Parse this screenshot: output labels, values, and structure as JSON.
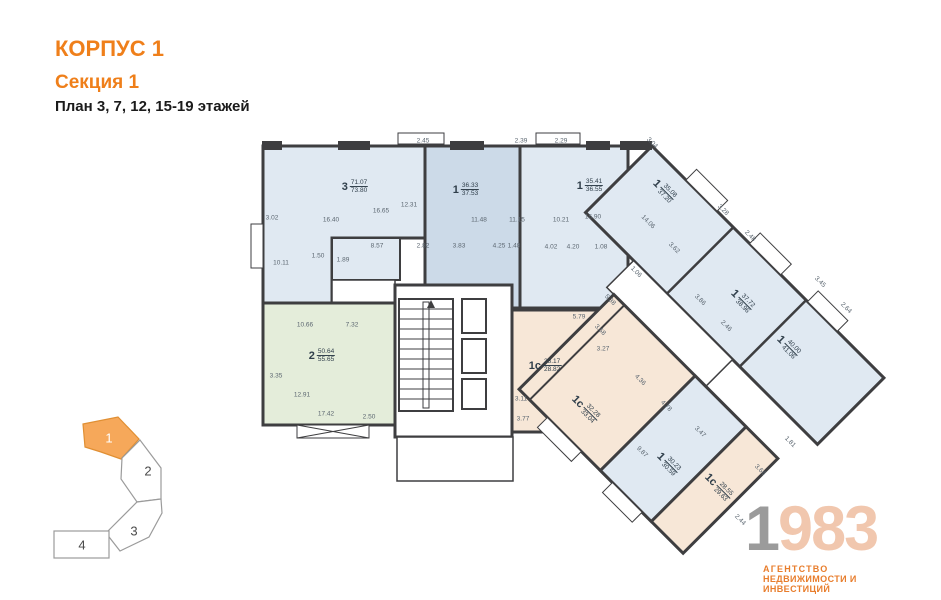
{
  "header": {
    "building": "КОРПУС 1",
    "section": "Секция 1",
    "plan_floors": "План 3, 7, 12, 15-19 этажей"
  },
  "colors": {
    "accent_orange": "#ef7f1a",
    "wall": "#3e3e40",
    "apartment_blue": "#e0e9f2",
    "apartment_blue_dark": "#ccdae8",
    "apartment_green": "#e4edda",
    "apartment_beige": "#f7e7d7",
    "key_plan_orange": "#f6a85a",
    "logo_gray": "#9b9b9b",
    "logo_peach": "#f1c7ae",
    "dimension_text": "#5b6670"
  },
  "plan": {
    "apartments": [
      {
        "type": "3",
        "area_top": "71.07",
        "area_bottom": "73.80",
        "x": 355,
        "y": 187,
        "r": 0
      },
      {
        "type": "1",
        "area_top": "36.33",
        "area_bottom": "37.53",
        "x": 466,
        "y": 190,
        "r": 0
      },
      {
        "type": "1",
        "area_top": "35.41",
        "area_bottom": "36.55",
        "x": 590,
        "y": 186,
        "r": 0
      },
      {
        "type": "1",
        "area_top": "35.08",
        "area_bottom": "37.20",
        "x": 664,
        "y": 191,
        "r": 45
      },
      {
        "type": "1",
        "area_top": "37.72",
        "area_bottom": "38.96",
        "x": 742,
        "y": 301,
        "r": 45
      },
      {
        "type": "1",
        "area_top": "40.00",
        "area_bottom": "41.06",
        "x": 788,
        "y": 347,
        "r": 45
      },
      {
        "type": "2",
        "area_top": "50.64",
        "area_bottom": "55.65",
        "x": 322,
        "y": 356,
        "r": 0
      },
      {
        "type": "1с",
        "area_top": "28.17",
        "area_bottom": "28.82",
        "x": 545,
        "y": 366,
        "r": 0
      },
      {
        "type": "1с",
        "area_top": "32.28",
        "area_bottom": "33.04",
        "x": 585,
        "y": 409,
        "r": 45
      },
      {
        "type": "1",
        "area_top": "30.23",
        "area_bottom": "30.59",
        "x": 668,
        "y": 464,
        "r": 45
      },
      {
        "type": "1с",
        "area_top": "28.55",
        "area_bottom": "29.63",
        "x": 718,
        "y": 487,
        "r": 45
      }
    ],
    "dimensions": [
      {
        "v": "2.45",
        "x": 423,
        "y": 141,
        "r": 0
      },
      {
        "v": "2.39",
        "x": 521,
        "y": 141,
        "r": 0
      },
      {
        "v": "2.29",
        "x": 561,
        "y": 141,
        "r": 0
      },
      {
        "v": "3.04",
        "x": 652,
        "y": 143,
        "r": 45
      },
      {
        "v": "3.02",
        "x": 272,
        "y": 218,
        "r": 0
      },
      {
        "v": "16.40",
        "x": 331,
        "y": 220,
        "r": 0
      },
      {
        "v": "16.65",
        "x": 381,
        "y": 211,
        "r": 0
      },
      {
        "v": "12.31",
        "x": 409,
        "y": 205,
        "r": 0
      },
      {
        "v": "11.48",
        "x": 479,
        "y": 220,
        "r": 0
      },
      {
        "v": "11.15",
        "x": 517,
        "y": 220,
        "r": 0
      },
      {
        "v": "10.21",
        "x": 561,
        "y": 220,
        "r": 0
      },
      {
        "v": "15.90",
        "x": 593,
        "y": 217,
        "r": 0
      },
      {
        "v": "8.57",
        "x": 377,
        "y": 246,
        "r": 0
      },
      {
        "v": "2.82",
        "x": 423,
        "y": 246,
        "r": 0
      },
      {
        "v": "3.83",
        "x": 459,
        "y": 246,
        "r": 0
      },
      {
        "v": "4.25",
        "x": 499,
        "y": 246,
        "r": 0
      },
      {
        "v": "1.48",
        "x": 514,
        "y": 246,
        "r": 0
      },
      {
        "v": "4.02",
        "x": 551,
        "y": 247,
        "r": 0
      },
      {
        "v": "4.20",
        "x": 573,
        "y": 247,
        "r": 0
      },
      {
        "v": "1.08",
        "x": 601,
        "y": 247,
        "r": 0
      },
      {
        "v": "1.50",
        "x": 318,
        "y": 256,
        "r": 0
      },
      {
        "v": "1.89",
        "x": 343,
        "y": 260,
        "r": 0
      },
      {
        "v": "10.11",
        "x": 281,
        "y": 263,
        "r": 0
      },
      {
        "v": "10.66",
        "x": 305,
        "y": 325,
        "r": 0
      },
      {
        "v": "7.32",
        "x": 352,
        "y": 325,
        "r": 0
      },
      {
        "v": "3.35",
        "x": 276,
        "y": 376,
        "r": 0
      },
      {
        "v": "12.91",
        "x": 302,
        "y": 395,
        "r": 0
      },
      {
        "v": "17.42",
        "x": 326,
        "y": 414,
        "r": 0
      },
      {
        "v": "2.50",
        "x": 369,
        "y": 417,
        "r": 0
      },
      {
        "v": "5.79",
        "x": 579,
        "y": 317,
        "r": 0
      },
      {
        "v": "3.27",
        "x": 603,
        "y": 349,
        "r": 0
      },
      {
        "v": "3.11",
        "x": 521,
        "y": 399,
        "r": 0
      },
      {
        "v": "3.77",
        "x": 523,
        "y": 419,
        "r": 0
      },
      {
        "v": "14.06",
        "x": 648,
        "y": 222,
        "r": 45
      },
      {
        "v": "3.62",
        "x": 674,
        "y": 248,
        "r": 45
      },
      {
        "v": "3.28",
        "x": 723,
        "y": 210,
        "r": 45
      },
      {
        "v": "2.48",
        "x": 750,
        "y": 236,
        "r": 45
      },
      {
        "v": "3.45",
        "x": 820,
        "y": 282,
        "r": 45
      },
      {
        "v": "2.64",
        "x": 846,
        "y": 308,
        "r": 45
      },
      {
        "v": "3.86",
        "x": 700,
        "y": 300,
        "r": 45
      },
      {
        "v": "2.46",
        "x": 726,
        "y": 326,
        "r": 45
      },
      {
        "v": "5.38",
        "x": 610,
        "y": 300,
        "r": 45
      },
      {
        "v": "1.06",
        "x": 636,
        "y": 272,
        "r": 45
      },
      {
        "v": "3.68",
        "x": 600,
        "y": 330,
        "r": 45
      },
      {
        "v": "4.36",
        "x": 640,
        "y": 380,
        "r": 45
      },
      {
        "v": "4.78",
        "x": 666,
        "y": 406,
        "r": 45
      },
      {
        "v": "3.47",
        "x": 700,
        "y": 432,
        "r": 45
      },
      {
        "v": "9.87",
        "x": 642,
        "y": 452,
        "r": 45
      },
      {
        "v": "3.66",
        "x": 760,
        "y": 470,
        "r": 45
      },
      {
        "v": "1.81",
        "x": 790,
        "y": 442,
        "r": 45
      },
      {
        "v": "2.44",
        "x": 740,
        "y": 520,
        "r": 45
      }
    ]
  },
  "key_plan": {
    "sections": [
      {
        "label": "1",
        "active": true
      },
      {
        "label": "2",
        "active": false
      },
      {
        "label": "3",
        "active": false
      },
      {
        "label": "4",
        "active": false
      }
    ]
  },
  "logo": {
    "year_first": "1",
    "year_rest": "983",
    "line1": "АГЕНТСТВО",
    "line2": "НЕДВИЖИМОСТИ И ИНВЕСТИЦИЙ"
  }
}
